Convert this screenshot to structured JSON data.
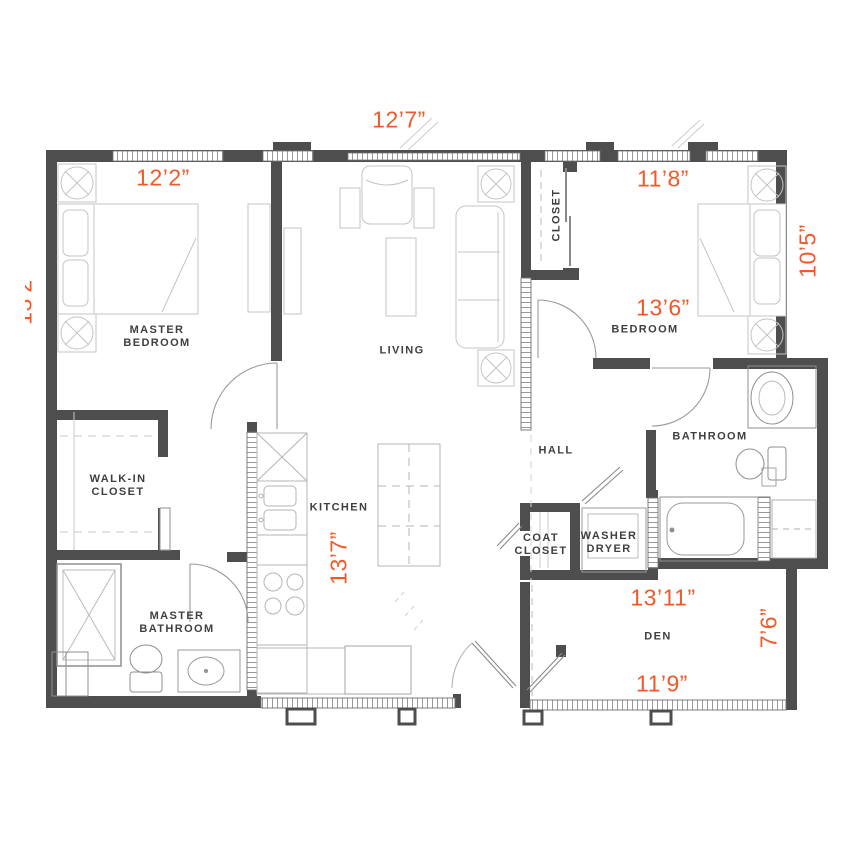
{
  "plan": {
    "title": "apartment-floor-plan",
    "colors": {
      "wall": "#4E4E4E",
      "dimension_text": "#F05A2B",
      "room_text": "#3F3F3F",
      "furniture_line": "#C4C4C4"
    },
    "rooms": {
      "master_bedroom": "MASTER\nBEDROOM",
      "living": "LIVING",
      "closet": "CLOSET",
      "bedroom": "BEDROOM",
      "walk_in_closet": "WALK-IN\nCLOSET",
      "kitchen": "KITCHEN",
      "hall": "HALL",
      "bathroom": "BATHROOM",
      "coat_closet": "COAT\nCLOSET",
      "washer_dryer": "WASHER\nDRYER",
      "master_bathroom": "MASTER\nBATHROOM",
      "den": "DEN"
    },
    "dimensions": {
      "top_width": "12’7”",
      "master_bedroom_width": "12’2”",
      "master_bedroom_depth": "13’2”",
      "bedroom_width": "11’8”",
      "bedroom_depth": "10’5”",
      "bedroom_length": "13’6”",
      "kitchen_depth": "13’7”",
      "den_width": "13’11”",
      "den_depth": "7’6”",
      "den_bottom_width": "11’9”"
    }
  }
}
